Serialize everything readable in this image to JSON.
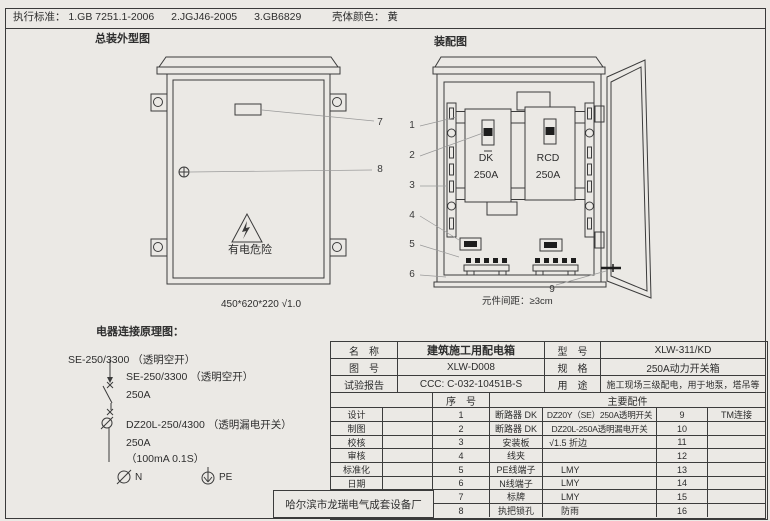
{
  "header": {
    "standards_label": "执行标准：",
    "standard_1": "1.GB 7251.1-2006",
    "standard_2": "2.JGJ46-2005",
    "standard_3": "3.GB6829",
    "shell_color_label": "壳体颜色：",
    "shell_color_value": "黄"
  },
  "outline_drawing": {
    "title": "总装外型图",
    "warning_text": "有电危险",
    "dimension_note": "450*620*220 √1.0",
    "callout_7": "7",
    "callout_8": "8"
  },
  "assembly_drawing": {
    "title": "装配图",
    "left_breaker_name": "DK",
    "left_breaker_rating": "250A",
    "right_breaker_name": "RCD",
    "right_breaker_rating": "250A",
    "callouts": [
      "1",
      "2",
      "3",
      "4",
      "5",
      "6"
    ],
    "callout_9": "9",
    "spacing_note": "元件间距：≥3cm"
  },
  "schematic": {
    "title": "电器连接原理图：",
    "incoming_label": "SE-250/3300 （透明空开）",
    "breaker1_label": "SE-250/3300 （透明空开）",
    "breaker1_rating": "250A",
    "breaker2_label": "DZ20L-250/4300 （透明漏电开关）",
    "breaker2_rating": "250A",
    "breaker2_trip": "（100mA 0.1S）",
    "n_label": "N",
    "pe_label": "PE"
  },
  "spec_table": {
    "info_rows": [
      {
        "label": "名　称",
        "value": "建筑施工用配电箱",
        "label2": "型　号",
        "value2": "XLW-311/KD"
      },
      {
        "label": "图　号",
        "value": "XLW-D008",
        "label2": "规　格",
        "value2": "250A动力开关箱"
      },
      {
        "label": "试验报告",
        "value": "CCC: C-032-10451B-S",
        "label2": "用　途",
        "value2": "施工现场三级配电，用于地泵，塔吊等"
      }
    ],
    "seq_header": "序　号",
    "parts_header": "主要配件",
    "sign_labels": [
      "设计",
      "制图",
      "校核",
      "审核",
      "标准化",
      "日期"
    ],
    "company": "哈尔滨市龙瑞电气成套设备厂",
    "parts": [
      {
        "no": "1",
        "name": "断路器 DK",
        "spec": "DZ20Y（SE）250A透明开关",
        "no2": "9",
        "spec2": "TM连接"
      },
      {
        "no": "2",
        "name": "断路器 DK",
        "spec": "DZ20L-250A透明漏电开关",
        "no2": "10",
        "spec2": ""
      },
      {
        "no": "3",
        "name": "安装板",
        "spec": "√1.5 折边",
        "no2": "11",
        "spec2": ""
      },
      {
        "no": "4",
        "name": "线夹",
        "spec": "",
        "no2": "12",
        "spec2": ""
      },
      {
        "no": "5",
        "name": "PE线端子",
        "spec": "LMY",
        "no2": "13",
        "spec2": ""
      },
      {
        "no": "6",
        "name": "N线端子",
        "spec": "LMY",
        "no2": "14",
        "spec2": ""
      },
      {
        "no": "7",
        "name": "标牌",
        "spec": "LMY",
        "no2": "15",
        "spec2": ""
      },
      {
        "no": "8",
        "name": "执把锁孔",
        "spec": "防雨",
        "no2": "16",
        "spec2": ""
      }
    ]
  }
}
